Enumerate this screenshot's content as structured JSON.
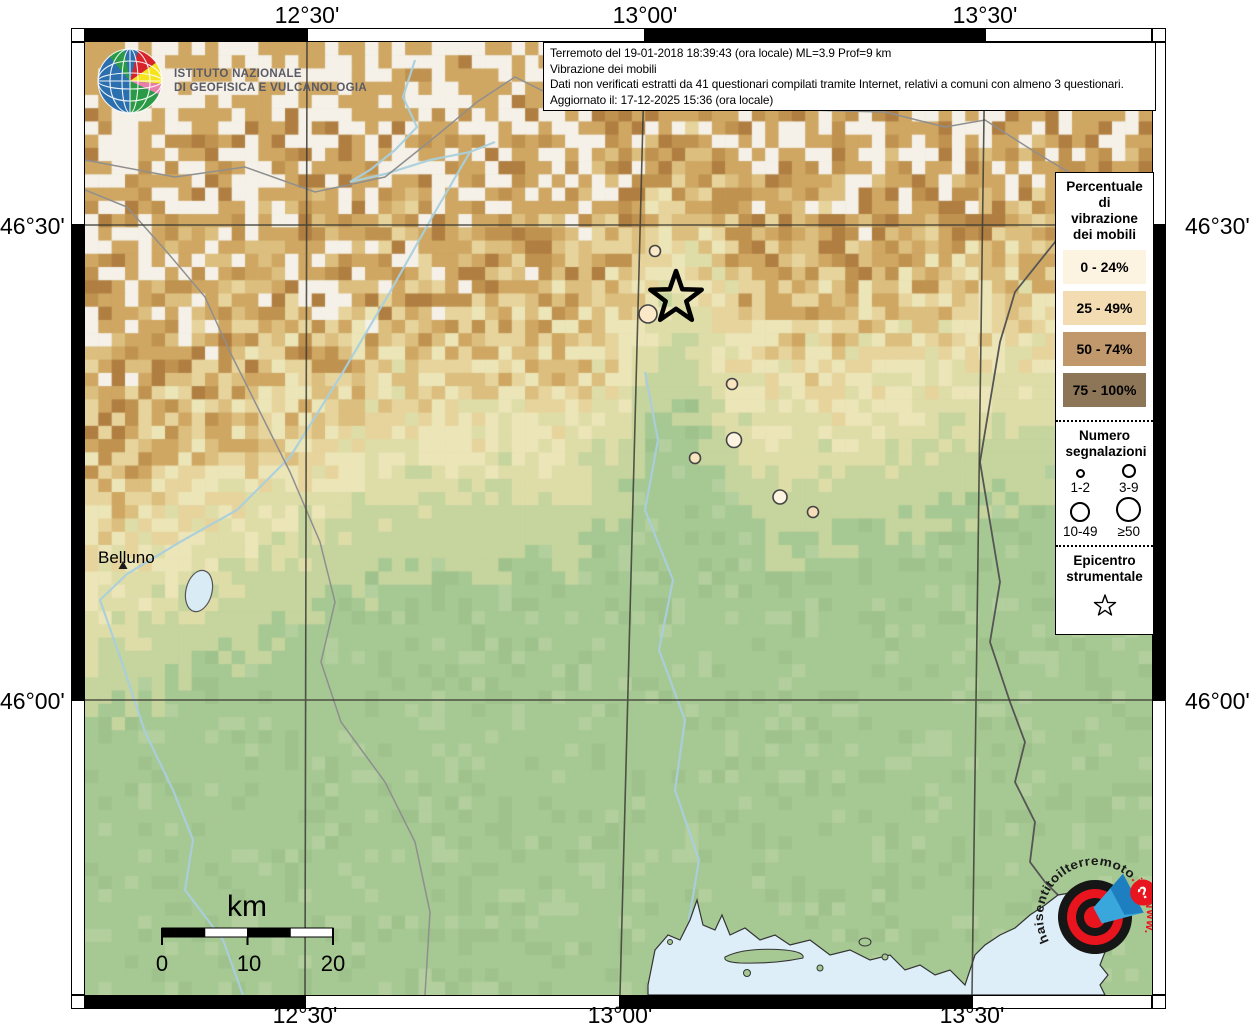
{
  "header": {
    "line1": "Terremoto del 19-01-2018 18:39:43 (ora locale) ML=3.9 Prof=9 km",
    "line2": "Vibrazione dei mobili",
    "line3": "Dati non verificati estratti da 41 questionari compilati tramite Internet, relativi a comuni con almeno 3 questionari.",
    "line4": "Aggiornato il: 17-12-2025 15:36 (ora locale)"
  },
  "ingv": {
    "line1": "ISTITUTO NAZIONALE",
    "line2": "DI GEOFISICA E VULCANOLOGIA"
  },
  "axes": {
    "top": [
      "12°30'",
      "13°00'",
      "13°30'"
    ],
    "bottom": [
      "12°30'",
      "13°00'",
      "13°30'"
    ],
    "left": [
      "46°30'",
      "46°00'"
    ],
    "right": [
      "46°30'",
      "46°00'"
    ]
  },
  "legend": {
    "percent_title": "Percentuale di vibrazione dei mobili",
    "classes": [
      {
        "label": "0 - 24%",
        "color": "#fdf3e1"
      },
      {
        "label": "25 - 49%",
        "color": "#f3dcb2"
      },
      {
        "label": "50 - 74%",
        "color": "#c0986c"
      },
      {
        "label": "75 - 100%",
        "color": "#8d7558"
      }
    ],
    "count_title": "Numero segnalazioni",
    "count_classes": [
      {
        "label": "1-2",
        "d": 9
      },
      {
        "label": "3-9",
        "d": 14
      },
      {
        "label": "10-49",
        "d": 20
      },
      {
        "label": "≥50",
        "d": 25
      }
    ],
    "epicenter_title": "Epicentro strumentale"
  },
  "map": {
    "city_label": "Belluno",
    "scalebar": {
      "unit": "km",
      "ticks": [
        "0",
        "10",
        "20"
      ]
    },
    "epicenter": {
      "x": 591,
      "y": 256
    },
    "reports": [
      {
        "x": 570,
        "y": 209,
        "r": 5.5,
        "color": "#fbe8c9"
      },
      {
        "x": 563,
        "y": 272,
        "r": 9.0,
        "color": "#fbe8c9"
      },
      {
        "x": 647,
        "y": 342,
        "r": 5.5,
        "color": "#f9e4c0"
      },
      {
        "x": 649,
        "y": 398,
        "r": 7.5,
        "color": "#fdf3e1"
      },
      {
        "x": 610,
        "y": 416,
        "r": 5.5,
        "color": "#f9e4c0"
      },
      {
        "x": 695,
        "y": 455,
        "r": 7.0,
        "color": "#fdf3e1"
      },
      {
        "x": 728,
        "y": 470,
        "r": 5.5,
        "color": "#f6ddb8"
      }
    ]
  },
  "watermark": {
    "www": "www.",
    "main": "haisentitoilterremoto",
    "tld": ".it",
    "question": "?"
  },
  "colors": {
    "plain_green": "#a6c893",
    "sea": "#ddeef8",
    "accent_red": "#e8141e",
    "river_blue": "#a9cfdd"
  }
}
